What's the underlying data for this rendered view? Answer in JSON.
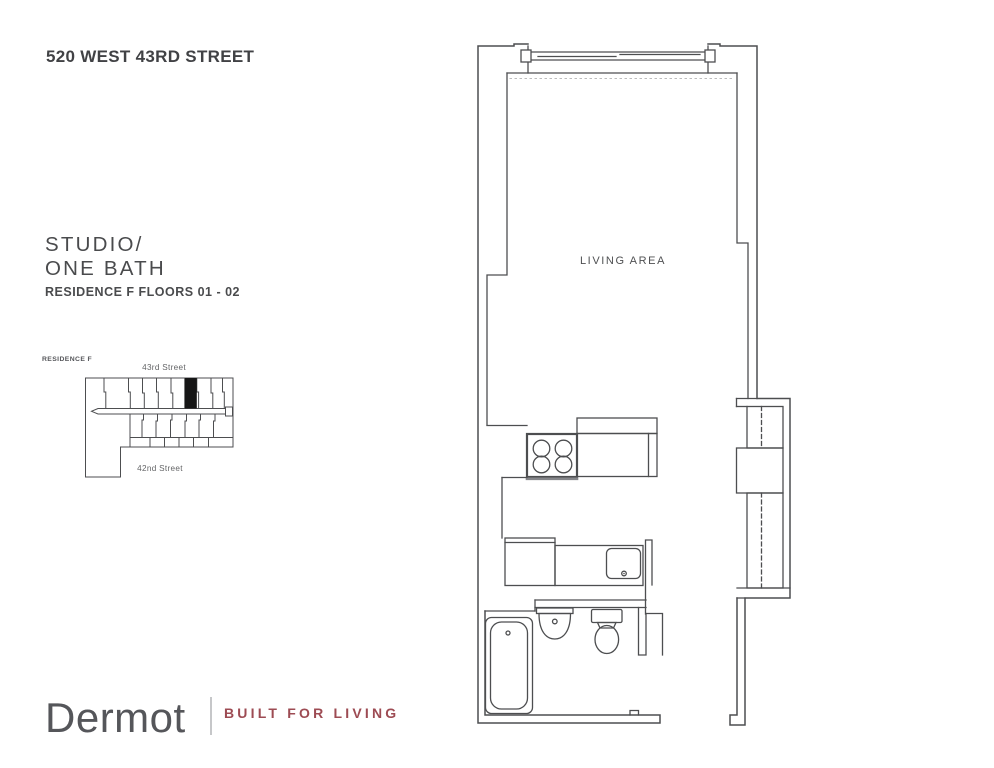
{
  "header": {
    "address": "520 WEST 43RD STREET"
  },
  "unit": {
    "type_line1": "STUDIO/",
    "type_line2": "ONE BATH",
    "residence_line": "RESIDENCE F FLOORS 01 - 02"
  },
  "key_plan": {
    "label": "RESIDENCE F",
    "street_top": "43rd Street",
    "street_bottom": "42nd Street",
    "highlight_color": "#161616"
  },
  "floor_plan": {
    "room_label": "LIVING AREA",
    "line_color": "#4d4e50",
    "icons": [
      "window-icon",
      "stove-icon",
      "kitchen-sink-icon",
      "bath-sink-icon",
      "toilet-icon",
      "bathtub-icon",
      "closet-rod-icon"
    ]
  },
  "footer": {
    "brand": "Dermot",
    "tagline": "BUILT FOR LIVING",
    "brand_color": "#55565a",
    "tagline_color": "#9d4b53"
  }
}
